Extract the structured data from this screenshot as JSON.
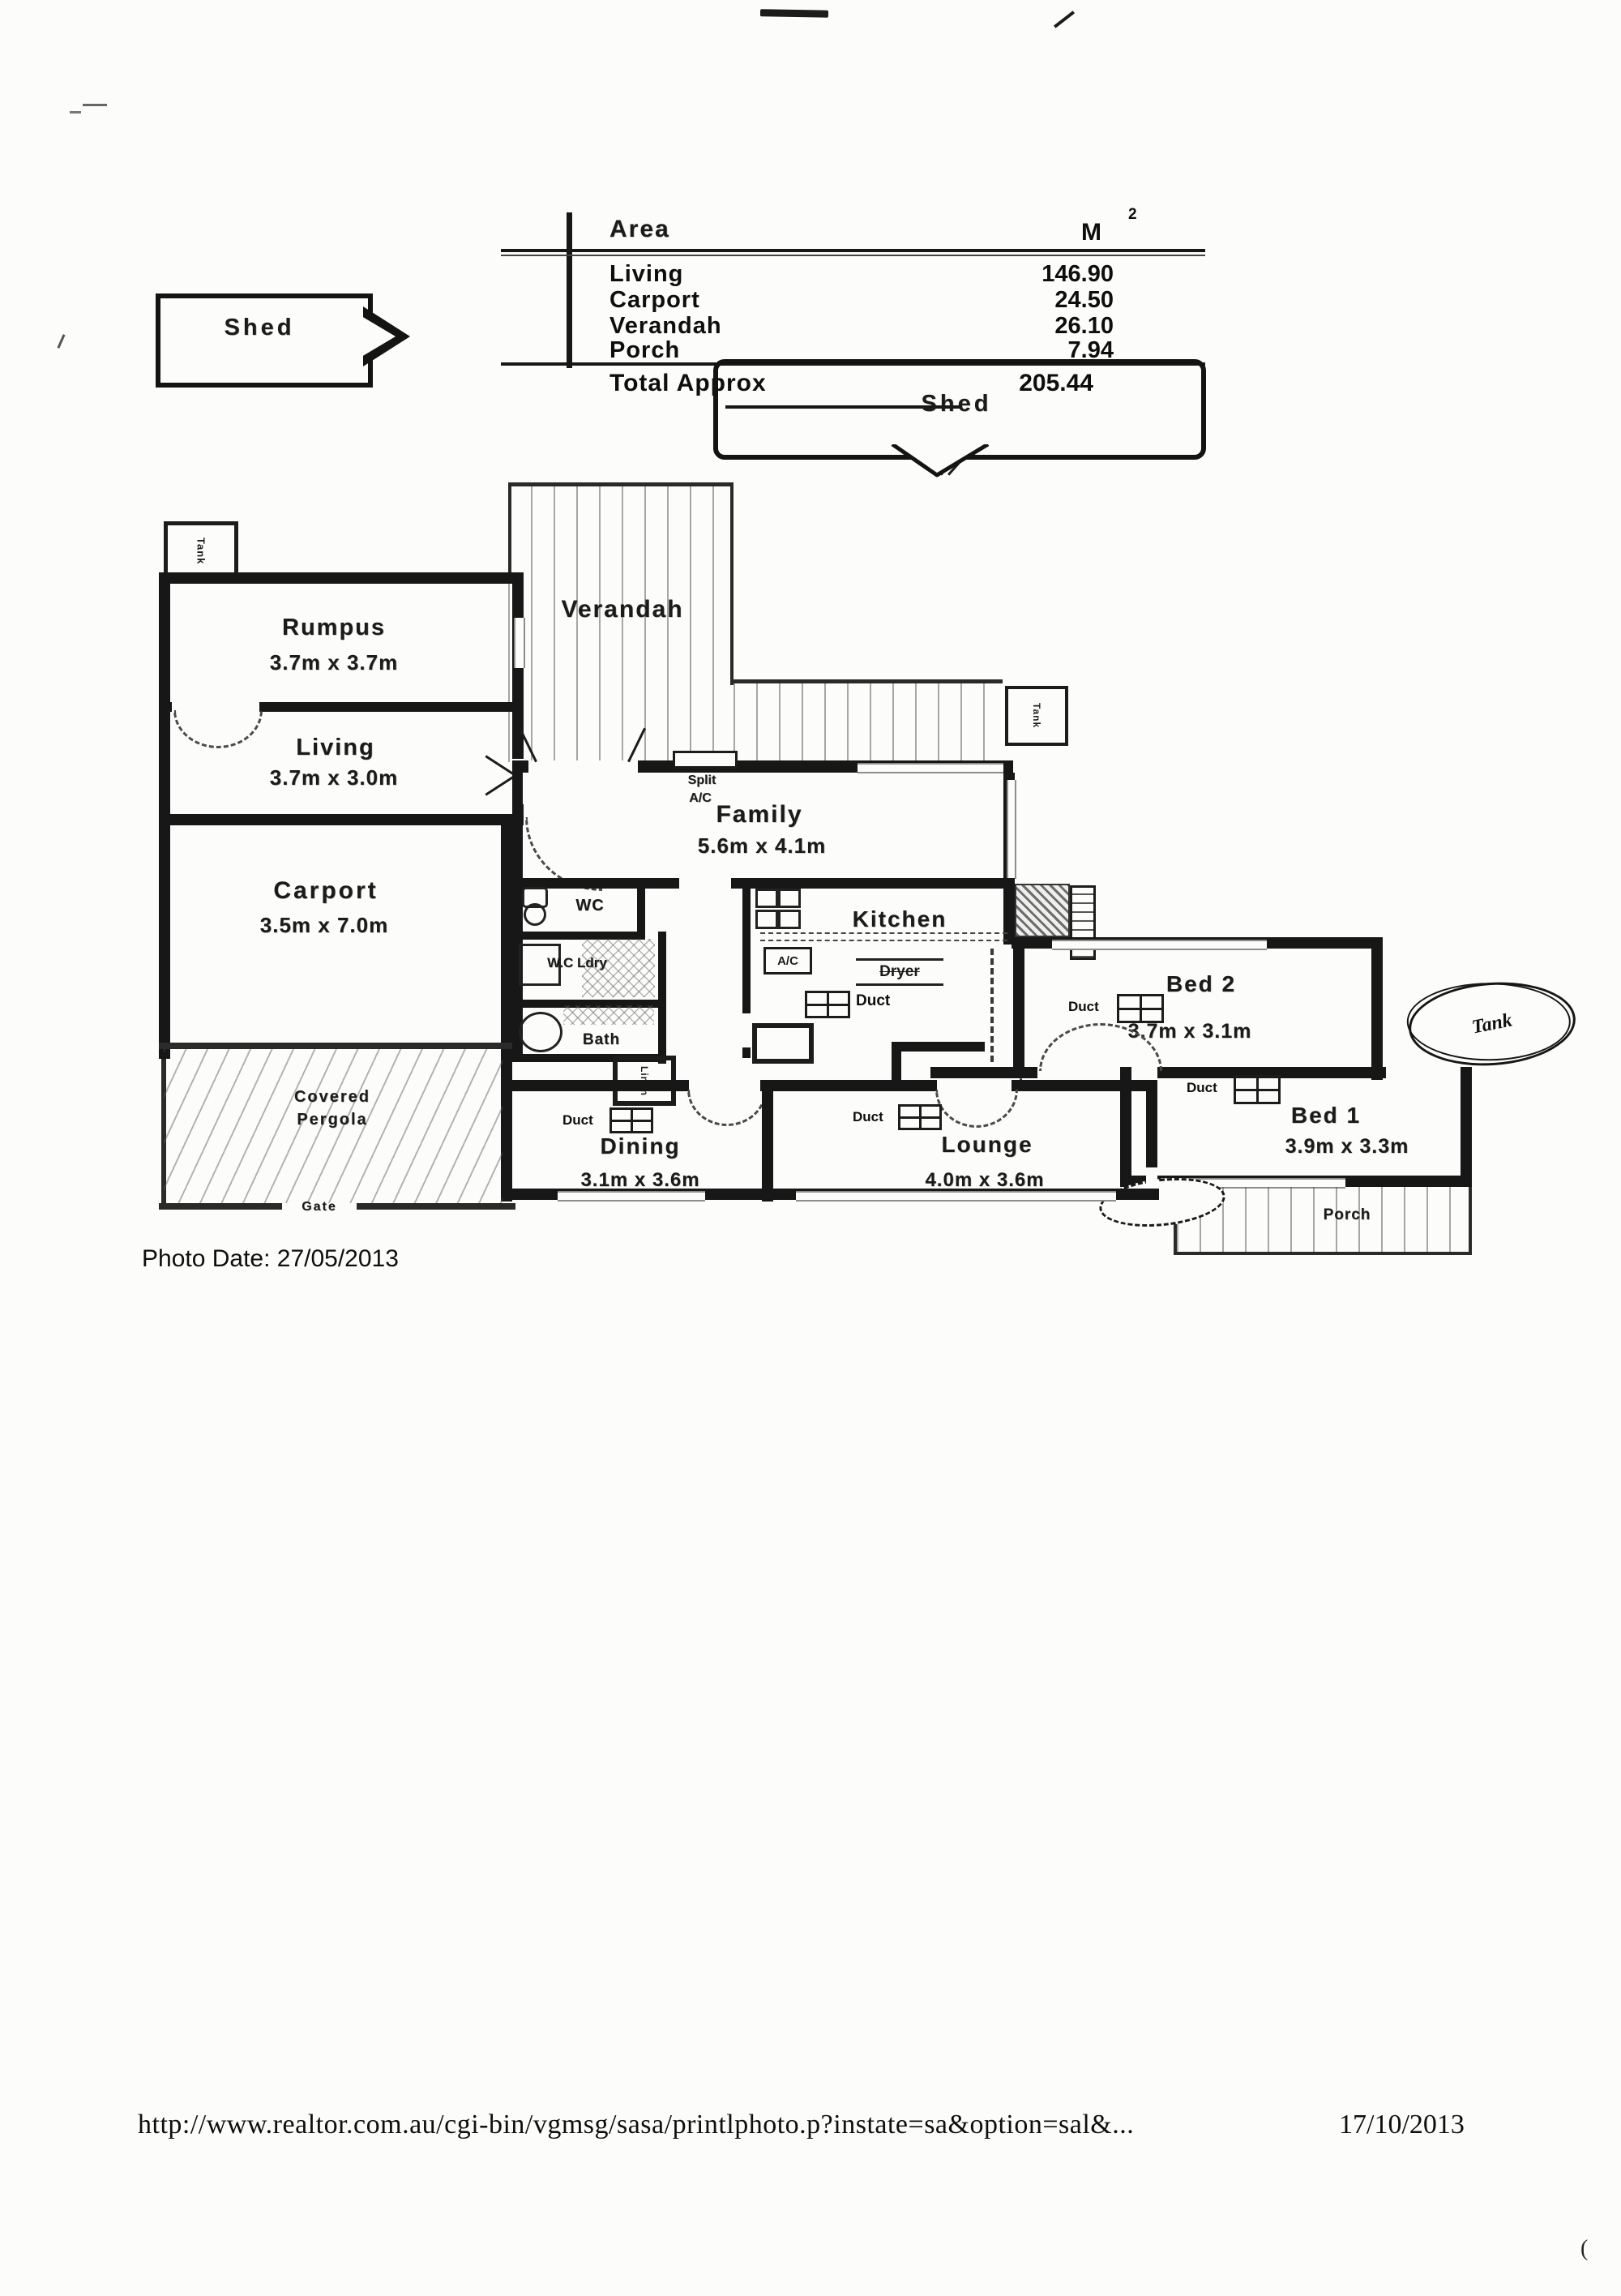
{
  "area_table": {
    "title": "Area",
    "unit": "M",
    "unit_sup": "2",
    "rows": [
      {
        "label": "Living",
        "value": "146.90"
      },
      {
        "label": "Carport",
        "value": "24.50"
      },
      {
        "label": "Verandah",
        "value": "26.10"
      },
      {
        "label": "Porch",
        "value": "7.94"
      }
    ],
    "total_label": "Total Approx",
    "total_value": "205.44"
  },
  "callouts": {
    "shed_small": "Shed",
    "shed_large": "Shed"
  },
  "rooms": {
    "rumpus": {
      "name": "Rumpus",
      "dims": "3.7m x 3.7m"
    },
    "living": {
      "name": "Living",
      "dims": "3.7m x 3.0m"
    },
    "verandah": {
      "name": "Verandah"
    },
    "family": {
      "name": "Family",
      "dims": "5.6m x 4.1m"
    },
    "kitchen": {
      "name": "Kitchen"
    },
    "carport": {
      "name": "Carport",
      "dims": "3.5m x 7.0m"
    },
    "pergola": {
      "line1": "Covered",
      "line2": "Pergola"
    },
    "dining": {
      "name": "Dining",
      "dims": "3.1m x 3.6m"
    },
    "lounge": {
      "name": "Lounge",
      "dims": "4.0m x 3.6m"
    },
    "bed2": {
      "name": "Bed 2",
      "dims": "3.7m x 3.1m"
    },
    "bed1": {
      "name": "Bed 1",
      "dims": "3.9m x 3.3m"
    },
    "porch": {
      "name": "Porch"
    },
    "wc": {
      "name": "WC"
    },
    "wc_ldry": {
      "name": "W.C Ldry"
    },
    "bath": {
      "name": "Bath"
    },
    "linen": {
      "name": "Linen"
    }
  },
  "fixtures": {
    "tank_top_left": "Tank",
    "tank_right": "Tank",
    "tank_handwritten": "Tank",
    "split_ac_line1": "Split",
    "split_ac_line2": "A/C",
    "ac_unit": "A/C",
    "dryer": "Dryer",
    "duct": "Duct",
    "gate": "Gate"
  },
  "footer": {
    "photo_date": "Photo Date: 27/05/2013",
    "url": "http://www.realtor.com.au/cgi-bin/vgmsg/sasa/printlphoto.p?instate=sa&option=sal&...",
    "print_date": "17/10/2013"
  }
}
